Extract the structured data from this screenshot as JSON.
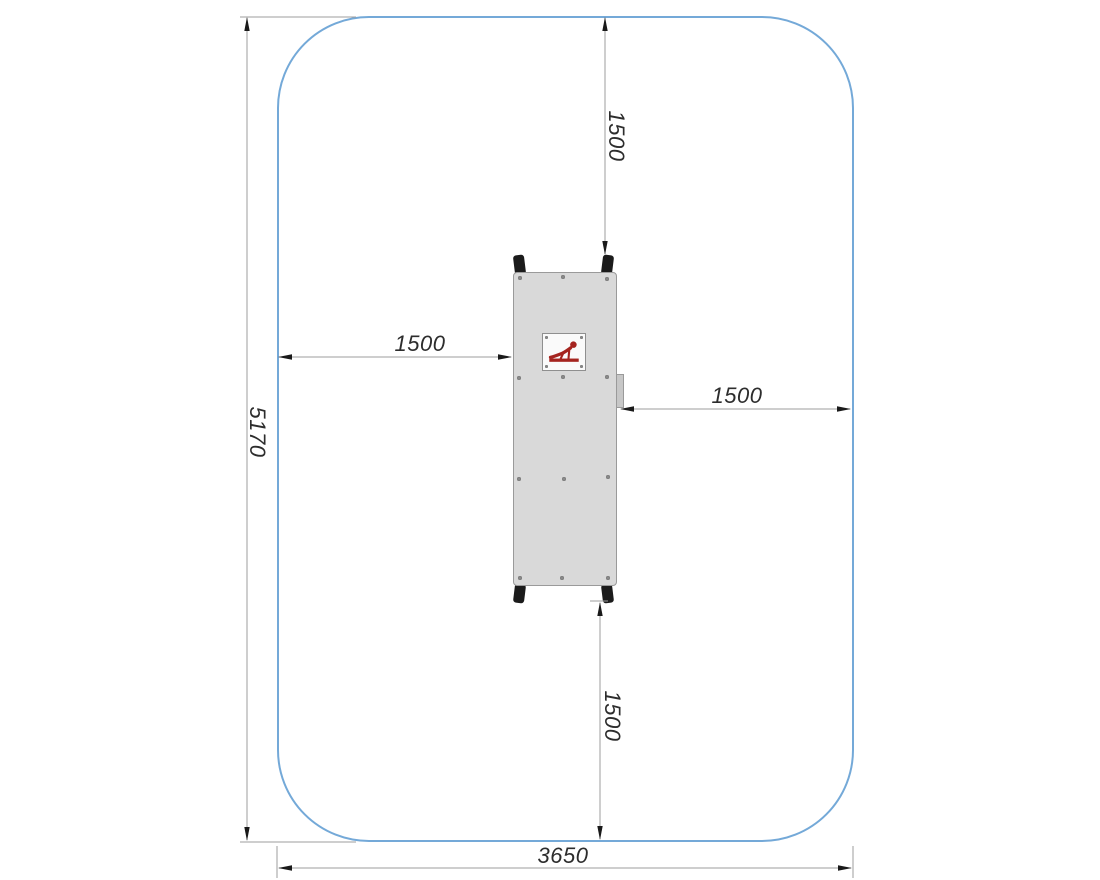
{
  "drawing": {
    "description": "plan-view installation drawing of outdoor push-up exercise equipment with safety zone",
    "dimension_labels": {
      "overall_height": "5170",
      "overall_width": "3650",
      "clearance_top": "1500",
      "clearance_bottom": "1500",
      "clearance_left": "1500",
      "clearance_right": "1500"
    },
    "icons": {
      "plaque_pictogram": "push-up-exercise-figure"
    },
    "colors": {
      "safety_zone_outline": "#74a9d8",
      "equipment_fill": "#d9d9d9",
      "equipment_outline": "#9a9a9a",
      "plaque_fill": "#fafafa",
      "pictogram_red": "#a5241f",
      "post_fill": "#1b1b1b",
      "dimension_line": "#9c9c9c",
      "arrow_fill": "#1a1a1a",
      "dimension_text": "#2d2d2d"
    }
  }
}
